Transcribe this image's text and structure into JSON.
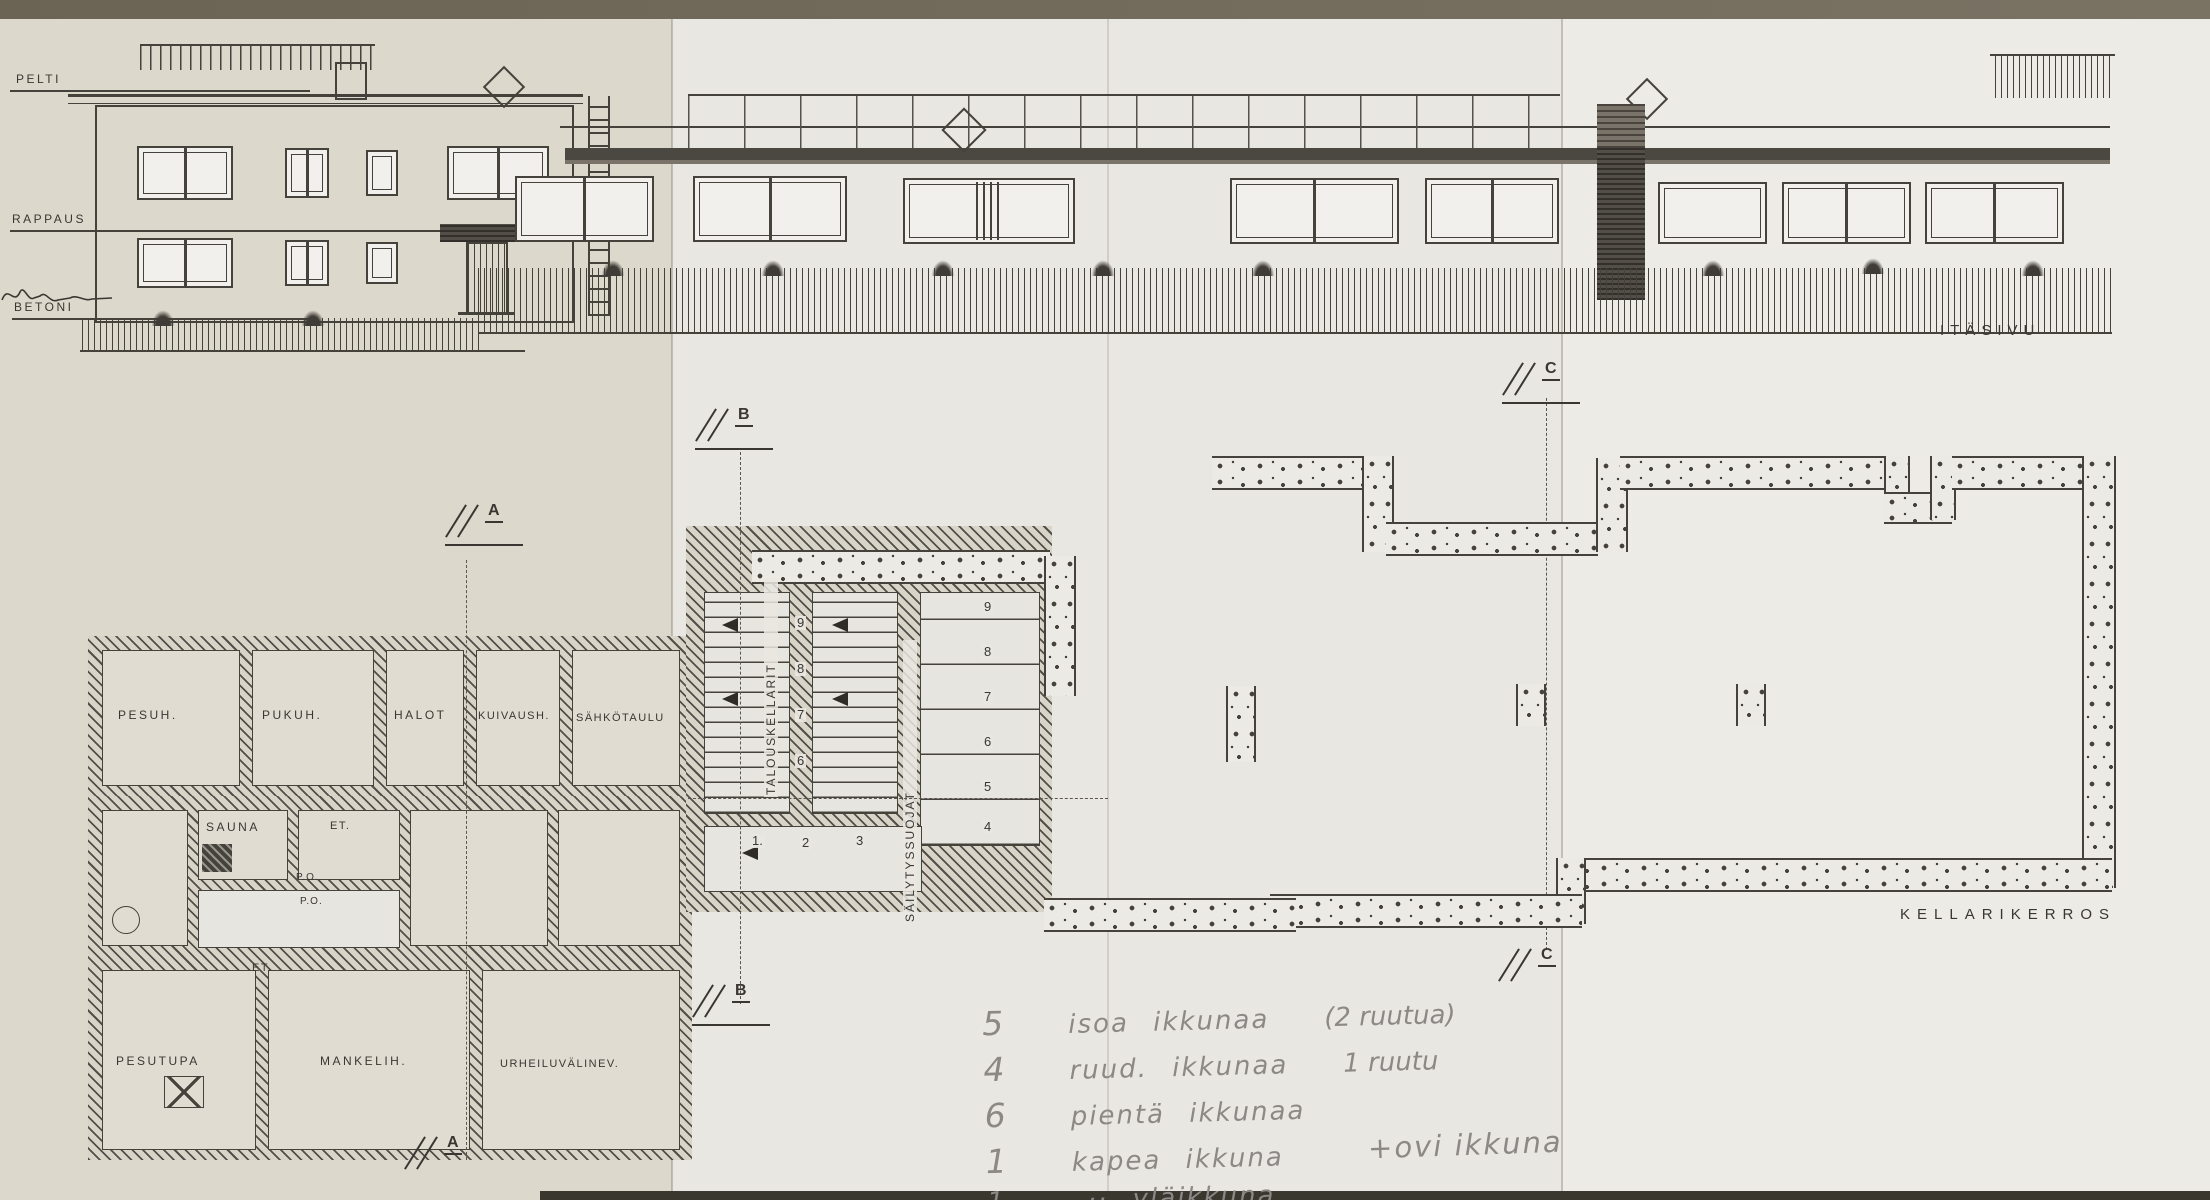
{
  "colors": {
    "ink": "#3a3733",
    "pencil": "#8b8886",
    "paper_left": "#ddd8cc",
    "paper_center": "#e9e7e1",
    "paper_right": "#ecebe6",
    "table_edge": "#6e6857"
  },
  "elevation": {
    "material_labels": [
      "PELTI",
      "RAPPAUS",
      "BETONI"
    ],
    "view_label": "ITÄSIVU"
  },
  "plan": {
    "title": "KELLARIKERROS",
    "rooms": {
      "pesuh": "PESUH.",
      "pukuh": "PUKUH.",
      "halot": "HALOT",
      "kuivaush": "KUIVAUSH.",
      "sahkotaulu": "SÄHKÖTAULU",
      "sauna": "SAUNA",
      "et1": "ET.",
      "po1": "P.O.",
      "po2": "P.O.",
      "et2": "ET.",
      "pesutupa": "PESUTUPA",
      "mankelih": "MANKELIH.",
      "urheiluvalinev": "URHEILUVÄLINEV."
    },
    "stairs": {
      "label_main": "TALOUSKELLARIT",
      "label_side": "SÄILYTYSSUOJAT",
      "numbers_left": [
        "9",
        "8",
        "7",
        "6"
      ],
      "numbers_right": [
        "9",
        "8",
        "7",
        "6",
        "5",
        "4"
      ],
      "numbers_bottom": [
        "1.",
        "2",
        "3"
      ]
    },
    "markers": [
      "A",
      "B",
      "B",
      "A",
      "C",
      "C"
    ]
  },
  "notes": {
    "lines": [
      {
        "qty": "5",
        "text": "isoa ikkunaa",
        "extra": "(2 ruutua)"
      },
      {
        "qty": "4",
        "text": "ruud. ikkunaa",
        "extra": "1 ruutu"
      },
      {
        "qty": "6",
        "text": "pientä ikkunaa",
        "extra": ""
      },
      {
        "qty": "1",
        "text": "kapea ikkuna",
        "extra": ""
      },
      {
        "qty": "1",
        "text": "–·· yläikkuna",
        "extra": ""
      }
    ],
    "total": "17",
    "door_note": "+ovi ikkuna"
  }
}
